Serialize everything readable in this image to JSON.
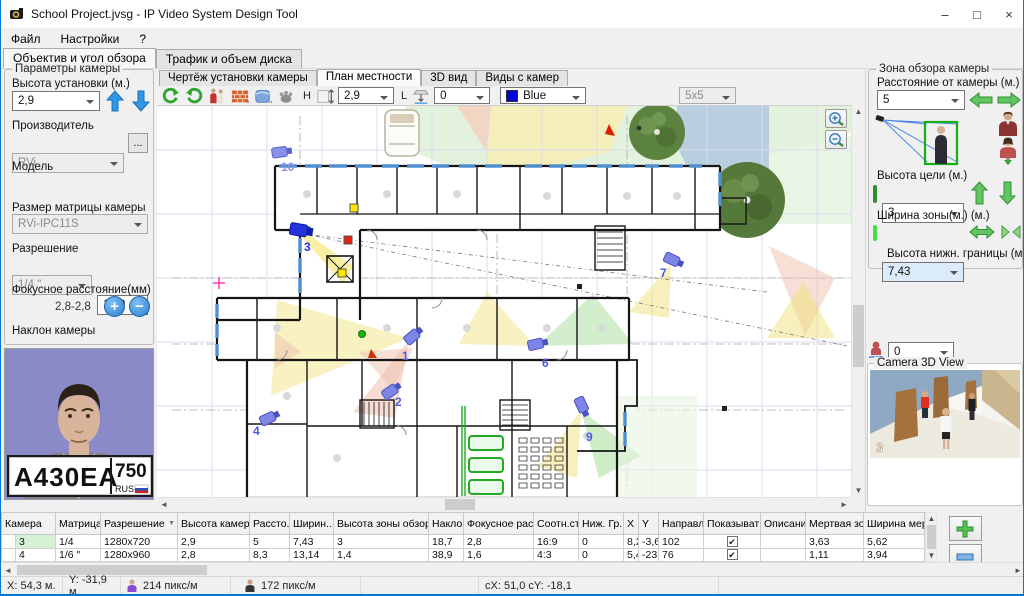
{
  "window": {
    "title": "School Project.jvsg - IP Video System Design Tool",
    "minimize": "–",
    "maximize": "□",
    "close": "×"
  },
  "menu": {
    "items": [
      "Файл",
      "Настройки",
      "?"
    ]
  },
  "main_tabs": {
    "items": [
      "Объектив и угол обзора",
      "Трафик и объем диска"
    ]
  },
  "camera_params": {
    "group_title": "Параметры камеры",
    "mount_height_label": "Высота установки (м.)",
    "mount_height": "2,9",
    "manufacturer_label": "Производитель",
    "manufacturer": "RVi",
    "more_button": "...",
    "model_label": "Модель",
    "model": "RVi-IPC11S",
    "sensor_label": "Размер матрицы камеры",
    "sensor": "1/4 \"",
    "aspect": "16:9",
    "resolution_label": "Разрешение",
    "resolution": "1280x720",
    "focal_label": "Фокусное расстояние(мм)",
    "focal": "2,8",
    "focal_range": "2,8-2,8",
    "tilt_label": "Наклон камеры",
    "tilt": "18,7"
  },
  "portrait": {
    "plate_main": "А430ЕА",
    "plate_region": "750",
    "plate_country": "RUS"
  },
  "plan": {
    "tabs": [
      "Чертёж установки камеры",
      "План местности",
      "3D вид",
      "Виды с камер"
    ],
    "toolbar": {
      "h_label": "H",
      "h_value": "2,9",
      "l_label": "L",
      "l_value": "0",
      "color_value": "Blue",
      "grid_value": "5x5"
    },
    "cameras": [
      {
        "label": "1"
      },
      {
        "label": "2"
      },
      {
        "label": "3"
      },
      {
        "label": "4"
      },
      {
        "label": "6"
      },
      {
        "label": "7"
      },
      {
        "label": "9"
      },
      {
        "label": "10"
      }
    ]
  },
  "view_zone": {
    "group_title": "Зона обзора камеры",
    "distance_label": "Расстояние от камеры (м.)",
    "distance": "5",
    "target_height_label": "Высота цели (м.)",
    "target_height": "3",
    "zone_width_label": "Ширина зоны(м.) (м.)",
    "zone_width": "7,43",
    "bottom_height_label": "Высота нижн. границы (м.)",
    "bottom_height": "0"
  },
  "view_angles": {
    "group_title": "Углы обзора *",
    "horizontal_label": "Горизонтальный угол",
    "horizontal": "65,5",
    "vertical_label": "Вертикальный",
    "vertical": "39,8"
  },
  "camera3d": {
    "title": "Camera 3D View",
    "camera_number": "3"
  },
  "table": {
    "headers": [
      "Камера",
      "Матрица",
      "Разрешение",
      "Высота камеры",
      "Рассто...",
      "Ширин...",
      "Высота зоны обзора",
      "Наклон",
      "Фокусное расс...",
      "Соотн.ст...",
      "Ниж. Гр...",
      "X",
      "Y",
      "Направле...",
      "Показывать",
      "Описание",
      "Мертвая зона",
      "Ширина мертв"
    ],
    "rows": [
      {
        "cells": [
          "3",
          "1/4",
          "1280x720",
          "2,9",
          "5",
          "7,43",
          "3",
          "18,7",
          "2,8",
          "16:9",
          "0",
          "8,2",
          "-3,6",
          "102",
          "✔",
          "",
          "3,63",
          "5,62"
        ]
      },
      {
        "cells": [
          "4",
          "1/6 \"",
          "1280x960",
          "2,8",
          "8,3",
          "13,14",
          "1,4",
          "38,9",
          "1,6",
          "4:3",
          "0",
          "5,4",
          "-23,7",
          "76",
          "✔",
          "",
          "1,11",
          "3,94"
        ]
      }
    ]
  },
  "status": {
    "x": "X: 54,3 м.",
    "y": "Y: -31,9 м.",
    "px_face": "214 пикс/м",
    "px_person": "172 пикс/м",
    "cursor": "cX: 51,0  cY: -18,1"
  }
}
